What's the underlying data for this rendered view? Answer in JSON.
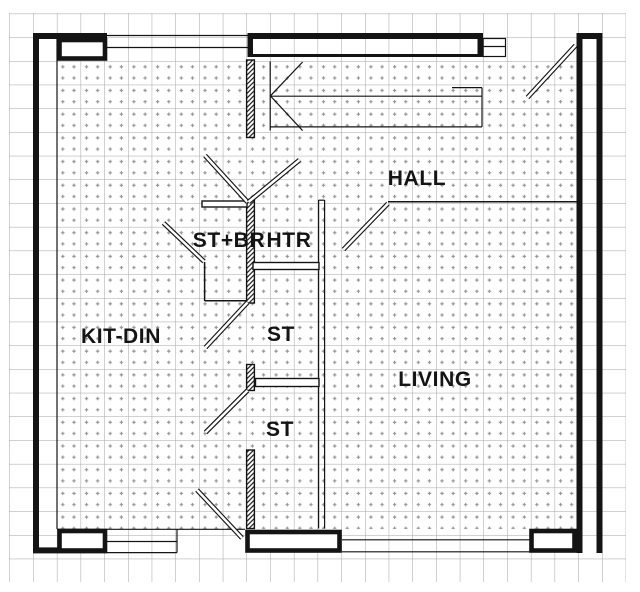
{
  "plan": {
    "type": "architectural-floor-plan",
    "rooms": [
      {
        "label": "HALL"
      },
      {
        "label": "ST+BR"
      },
      {
        "label": "HTR"
      },
      {
        "label": "KIT-DIN"
      },
      {
        "label": "ST"
      },
      {
        "label": "ST"
      },
      {
        "label": "LIVING"
      }
    ],
    "colors": {
      "wall": "#141414",
      "grid": "#a3a3a3",
      "floor_dots": "#969696",
      "background": "#ffffff"
    }
  }
}
